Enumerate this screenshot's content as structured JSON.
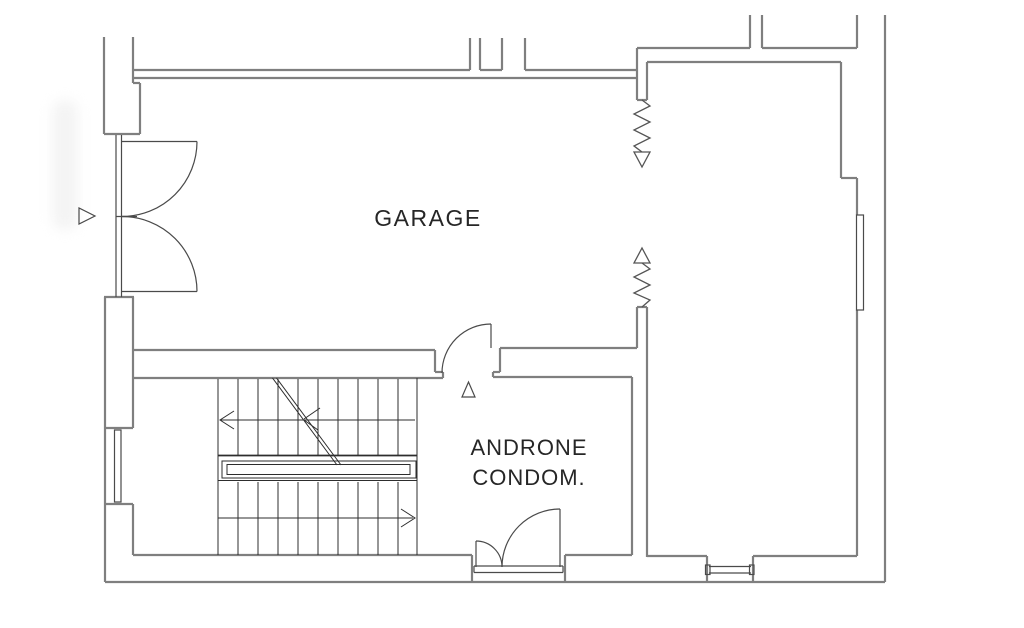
{
  "document": {
    "type": "architectural-floor-plan",
    "view": "ground-floor plan with garage, stairwell and condominium entrance hall"
  },
  "labels": {
    "garage": "GARAGE",
    "androne_line1": "ANDRONE",
    "androne_line2": "CONDOM."
  },
  "symbols": [
    "entrance-direction-triangle-left",
    "entrance-direction-triangle-androne",
    "double-swing-entrance-door",
    "interior-single-door",
    "androne-double-leaf-door",
    "spring-coil-arrow-top",
    "spring-coil-arrow-bottom",
    "staircase-with-direction-arrows",
    "stair-break-line",
    "window-left-wall",
    "window-bottom-wall",
    "niche-right-wall"
  ],
  "colors": {
    "background": "#ffffff",
    "wall_line": "#7f7f7f",
    "detail_line": "#3d3d3d",
    "stair_line": "#2d2d2d",
    "text": "#262626"
  }
}
